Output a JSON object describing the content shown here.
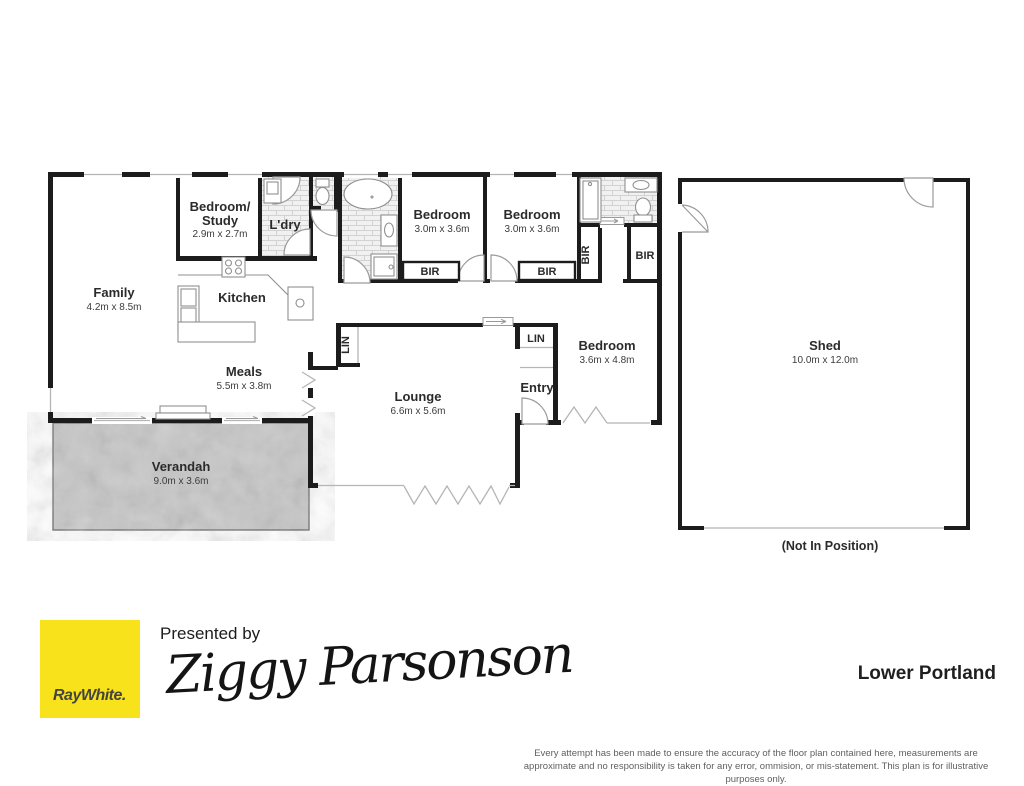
{
  "plan": {
    "rooms": {
      "family": {
        "name": "Family",
        "dims": "4.2m x 8.5m"
      },
      "bedroom_study": {
        "name_line1": "Bedroom/",
        "name_line2": "Study",
        "dims": "2.9m x 2.7m"
      },
      "laundry": {
        "name": "L'dry"
      },
      "kitchen": {
        "name": "Kitchen"
      },
      "bedroom1": {
        "name": "Bedroom",
        "dims": "3.0m x 3.6m"
      },
      "bedroom2": {
        "name": "Bedroom",
        "dims": "3.0m x 3.6m"
      },
      "bedroom3": {
        "name": "Bedroom",
        "dims": "3.6m x 4.8m"
      },
      "meals": {
        "name": "Meals",
        "dims": "5.5m x 3.8m"
      },
      "lounge": {
        "name": "Lounge",
        "dims": "6.6m x 5.6m"
      },
      "entry": {
        "name": "Entry"
      },
      "verandah": {
        "name": "Verandah",
        "dims": "9.0m x 3.6m"
      },
      "shed": {
        "name": "Shed",
        "dims": "10.0m x 12.0m",
        "note": "(Not In Position)"
      }
    },
    "closets": {
      "bir": "BIR",
      "lin": "LIN"
    },
    "colors": {
      "wall": "#1c1c1c",
      "tile_line": "#d2d2d2",
      "tile_fill": "#f1f1f1",
      "verandah": "#c7c7c7",
      "fixture": "#8f8f8f",
      "opening": "#b5b5b5"
    }
  },
  "footer": {
    "brand": {
      "logo_text": "RayWhite.",
      "yellow": "#F7E21C",
      "text_color": "#45453c"
    },
    "presented_by": "Presented by",
    "agent_signature": "Ziggy Parsonson",
    "location": "Lower Portland",
    "disclaimer": "Every attempt has been made to ensure the accuracy of the floor plan contained here, measurements are approximate and no responsibility is taken for any error, ommision, or mis-statement. This plan is for illustrative purposes only."
  }
}
